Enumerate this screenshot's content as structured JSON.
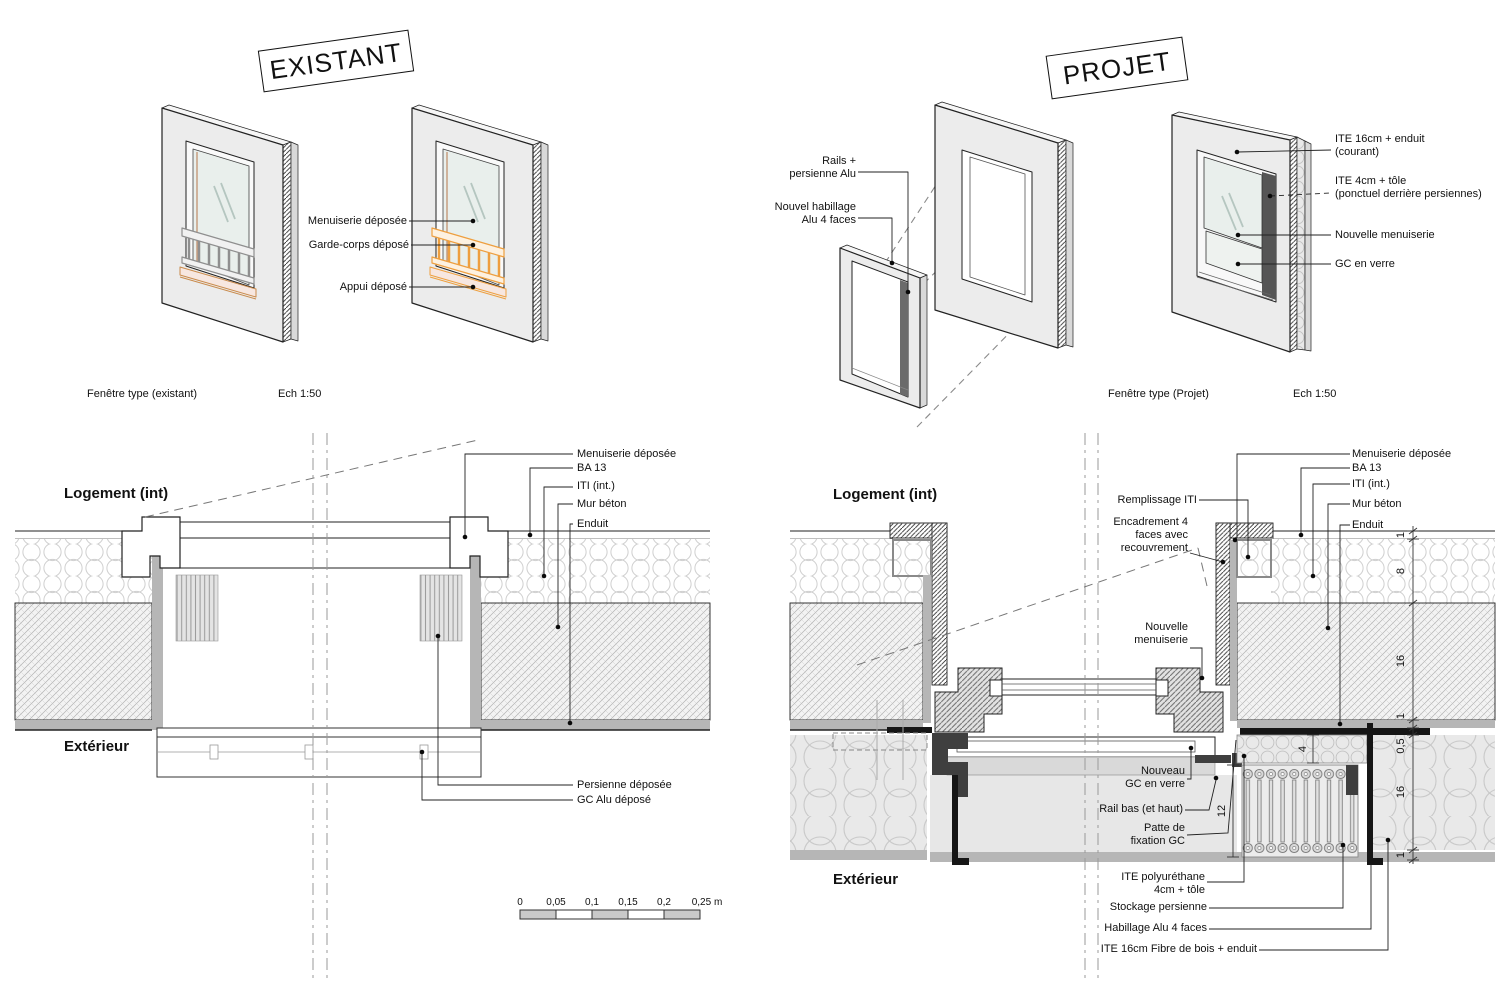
{
  "existant": {
    "title": "EXISTANT",
    "caption": "Fenêtre type (existant)",
    "scale": "Ech 1:50",
    "labels": {
      "menuiserie": "Menuiserie déposée",
      "garde_corps": "Garde-corps déposé",
      "appui": "Appui déposé"
    }
  },
  "projet": {
    "title": "PROJET",
    "caption": "Fenêtre type (Projet)",
    "scale": "Ech 1:50",
    "labels": {
      "rails": "Rails +\npersienne Alu",
      "habillage": "Nouvel habillage\nAlu 4 faces",
      "ite16": "ITE 16cm + enduit\n(courant)",
      "ite4": "ITE 4cm + tôle\n(ponctuel derrière persiennes)",
      "menuiserie": "Nouvelle menuiserie",
      "gc": "GC en verre"
    }
  },
  "detail_existant": {
    "room": "Logement (int)",
    "exterior": "Extérieur",
    "labels": {
      "menuiserie_deposee": "Menuiserie déposée",
      "ba13": "BA 13",
      "iti": "ITI (int.)",
      "mur_beton": "Mur béton",
      "enduit": "Enduit",
      "persienne": "Persienne déposée",
      "gc_alu": "GC Alu déposé"
    }
  },
  "detail_projet": {
    "room": "Logement (int)",
    "exterior": "Extérieur",
    "labels": {
      "remplissage": "Remplissage ITI",
      "encadrement": "Encadrement 4\nfaces avec\nrecouvrement",
      "nouvelle_menuiserie": "Nouvelle\nmenuiserie",
      "nouveau_gc": "Nouveau\nGC en verre",
      "rail_bas": "Rail bas (et haut)",
      "patte": "Patte de\nfixation GC",
      "ite_poly": "ITE polyuréthane\n4cm + tôle",
      "stockage": "Stockage persienne",
      "habillage": "Habillage Alu 4 faces",
      "ite_fibre": "ITE 16cm Fibre de bois + enduit",
      "menuiserie_deposee": "Menuiserie déposée",
      "ba13": "BA 13",
      "iti": "ITI (int.)",
      "mur_beton": "Mur béton",
      "enduit": "Enduit"
    },
    "dims": {
      "d1": "1",
      "d2": "8",
      "d3": "16",
      "d4": "1",
      "d5": "0,5",
      "d6": "16",
      "d7": "1",
      "d8": "4",
      "d9": "12"
    }
  },
  "scalebar": {
    "t0": "0",
    "t1": "0,05",
    "t2": "0,1",
    "t3": "0,15",
    "t4": "0,2",
    "t5": "0,25 m"
  },
  "colors": {
    "highlight": "#EE9F3F",
    "sill_pink": "#F7E7E0",
    "glass": "#E9EFEC",
    "wall": "#ECECEC",
    "dark": "#3F3F3F"
  }
}
